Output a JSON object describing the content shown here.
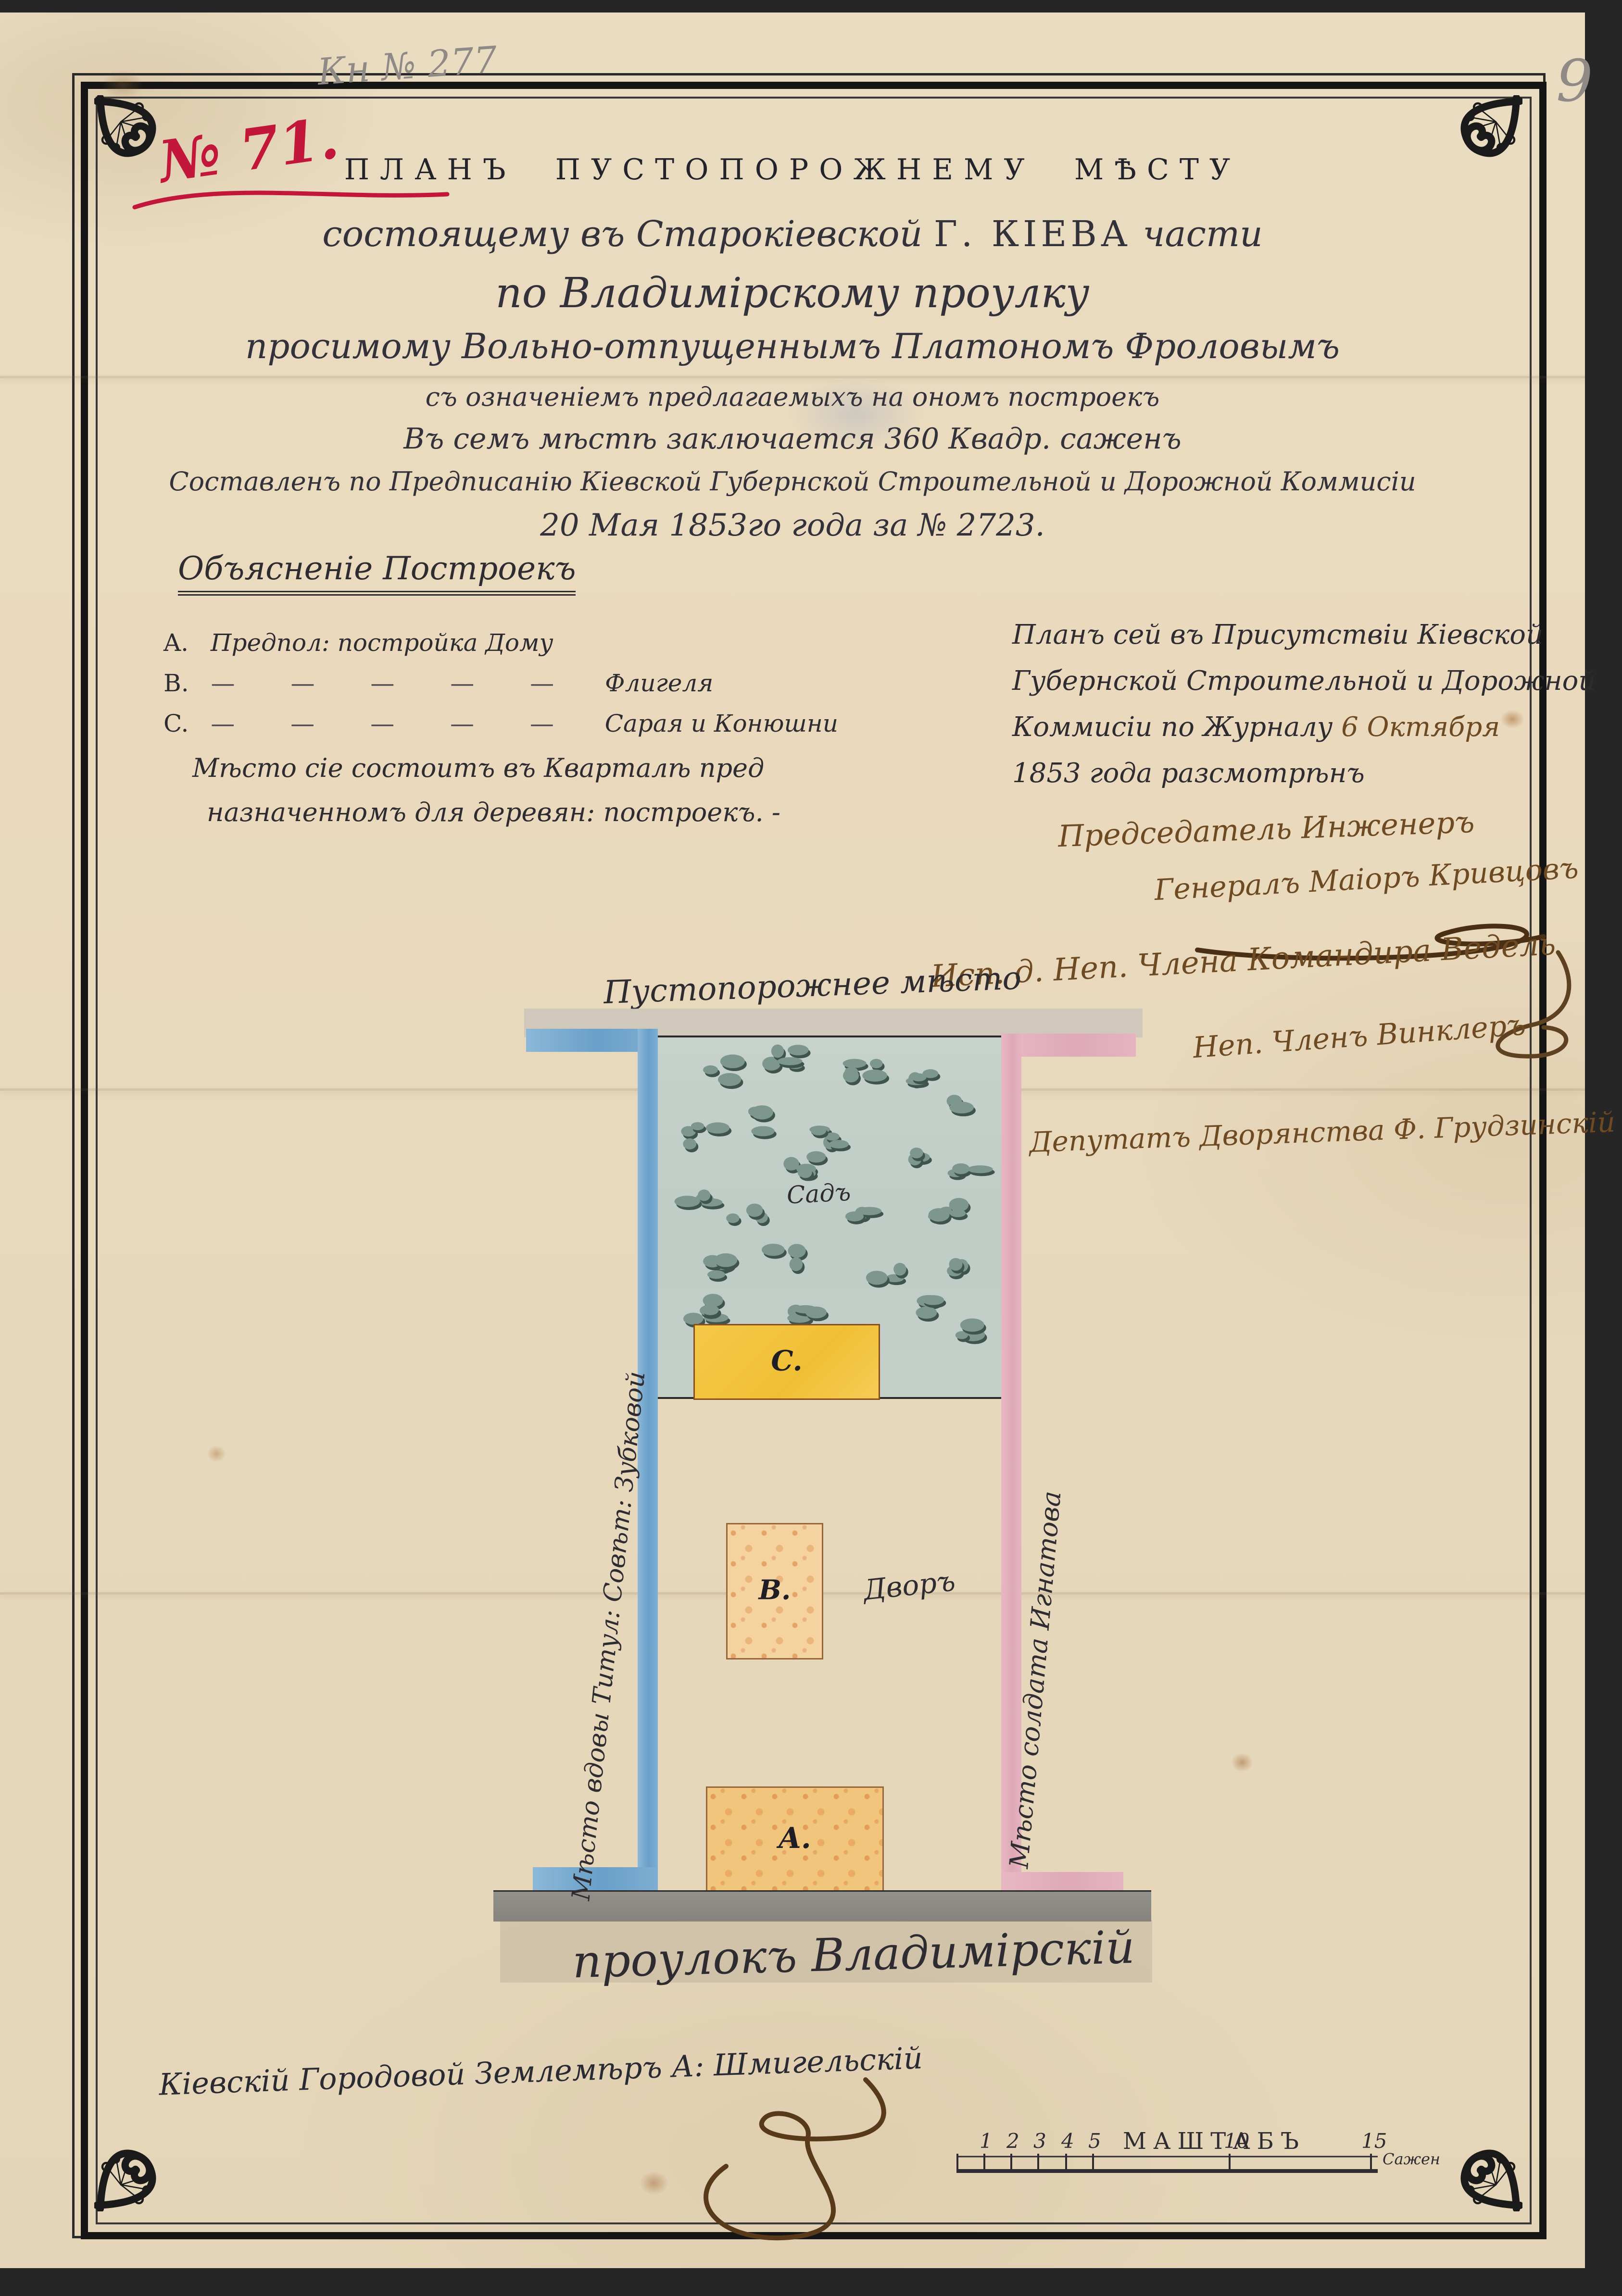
{
  "page": {
    "pencil_note": "Кн № 277",
    "page_number": "9",
    "case_number": "№ 71."
  },
  "title": {
    "line0": "ПЛАНЪ ПУСТОПОРОЖНЕМУ МѢСТУ",
    "line1a": "состоящему въ Старокіевской ",
    "line1b": "Г. КІЕВА",
    "line1c": " части",
    "line2": "по Владимірскому проулку",
    "line3": "просимому Вольно-отпущеннымъ Платономъ Фроловымъ",
    "line4": "съ означеніемъ предлагаемыхъ на ономъ построекъ",
    "line5": "Въ семъ мѣстѣ заключается 360 Квадр. саженъ",
    "line6": "Составленъ по Предписанію Кіевской Губернской Строительной и Дорожной Коммисіи",
    "line7": "20 Мая 1853го года за № 2723."
  },
  "legend": {
    "heading": "Объясненіе Построекъ",
    "a_key": "A.",
    "a_text": "Предпол: постройка Дому",
    "b_key": "B.",
    "b_dashes": "— — — — —",
    "b_text": "Флигеля",
    "c_key": "C.",
    "c_dashes": "— — — — —",
    "c_text": "Сарая и Конюшни",
    "note1": "Мѣсто сіе состоитъ въ Кварталѣ пред",
    "note2": "назначенномъ для деревян: построекъ. -"
  },
  "commission": {
    "line1": "Планъ сей въ Присутствіи Кіевской",
    "line2": "Губернской Строительной и Дорожной",
    "line3a": "Коммисіи по Журналу ",
    "line3b": "6 Октября",
    "line4": "1853 года разсмотрѣнъ",
    "chair1": "Председатель Инженеръ",
    "chair2": "Генералъ Маіоръ Кривцовъ"
  },
  "signatures": {
    "s1": "Исп. д. Неп. Члена Командира Ведель",
    "s2": "Неп. Членъ Винклеръ",
    "s3": "Депутатъ Дворянства Ф. Грудзинскій"
  },
  "plan": {
    "top_label": "Пустопорожнее мѣсто",
    "left_label": "Мѣсто вдовы Титул: Совѣт: Зубковой",
    "right_label": "Мѣсто солдата Игнатова",
    "garden_label": "Садъ",
    "yard_label": "Дворъ",
    "building_a": "A.",
    "building_b": "B.",
    "building_c": "C.",
    "street_label": "проулокъ Владимірскій"
  },
  "footer": {
    "surveyor": "Кіевскій Городовой Землемѣръ А: Шмигельскій",
    "scale": {
      "label": "МАШТАБЪ",
      "unit": "Сажен",
      "t1": "1",
      "t2": "2",
      "t3": "3",
      "t4": "4",
      "t5": "5",
      "t6": "10",
      "t7": "15"
    }
  },
  "colors": {
    "paper": "#e9dcc1",
    "ink_black": "#2e2c30",
    "ink_brown": "#6d4a22",
    "ink_red": "#c2173a",
    "pencil": "#8f8a86",
    "strip_blue": "#74a9cf",
    "strip_pink": "#e3b0bc",
    "garden_green": "#c3cfc7",
    "tree_green": "#7d968e",
    "building_yellow": "#f2c440",
    "building_tan": "#f5d3a0",
    "street_gray": "#8d8a84"
  }
}
